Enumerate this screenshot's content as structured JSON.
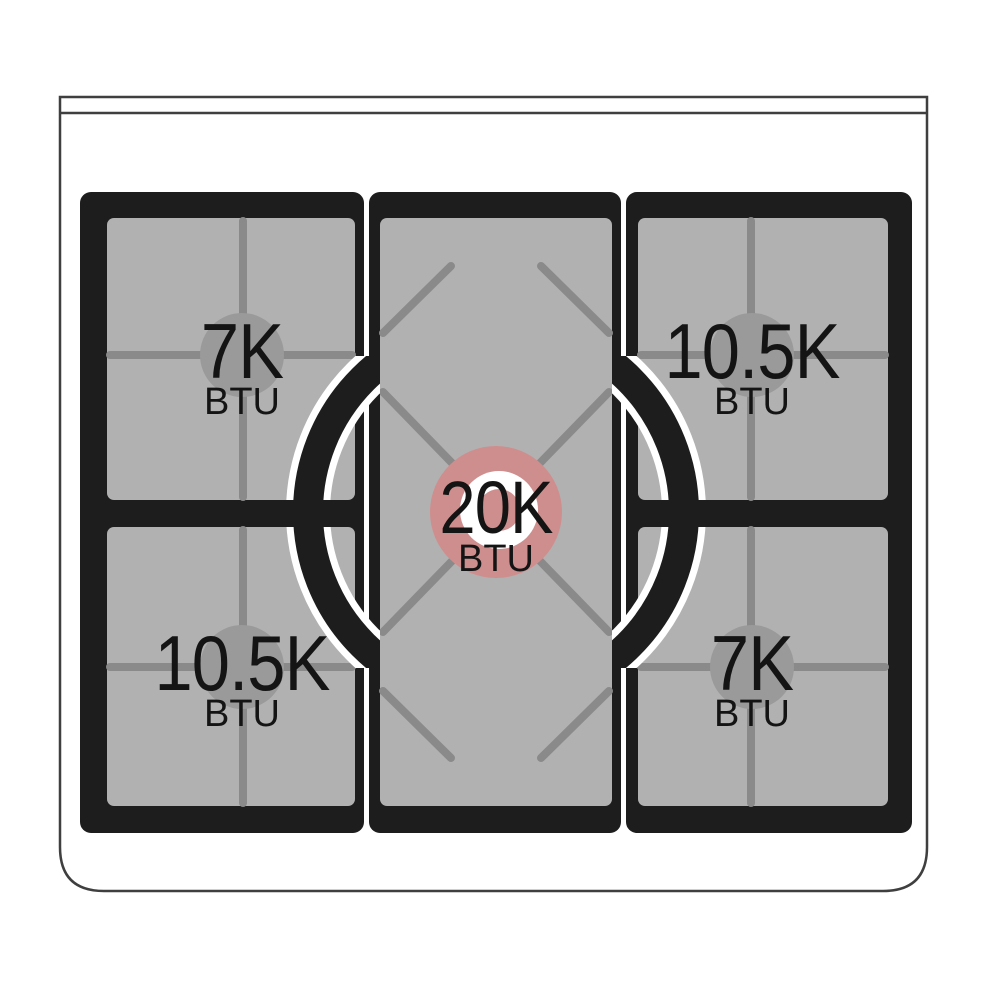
{
  "title": "Gas cooktop burner power diagram",
  "burners": {
    "rear_left": {
      "value": "7K",
      "unit": "BTU"
    },
    "rear_right": {
      "value": "10.5K",
      "unit": "BTU"
    },
    "center": {
      "value": "20K",
      "unit": "BTU"
    },
    "front_left": {
      "value": "10.5K",
      "unit": "BTU"
    },
    "front_right": {
      "value": "7K",
      "unit": "BTU"
    }
  },
  "colors": {
    "grate": "#1d1d1d",
    "surface": "#b1b1b1",
    "grate_line": "#8a8a8a",
    "burner_cap": "#9a9a9a",
    "center_burner_highlight": "#cf8e8e",
    "body_outline": "#3f3f3f",
    "label_text": "#141414"
  }
}
